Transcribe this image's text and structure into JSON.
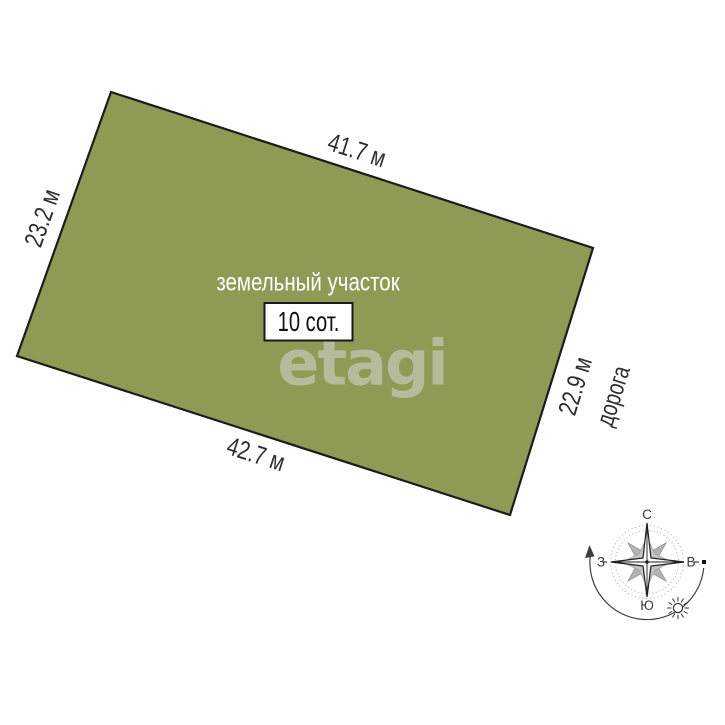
{
  "plot": {
    "label": "земельный участок",
    "area": "10 сот.",
    "fill_color": "#8e9b55",
    "border_color": "#1c1c1c",
    "dimensions": {
      "top": "41.7 м",
      "left": "23.2 м",
      "right": "22.9 м",
      "bottom": "42.7 м"
    }
  },
  "road_label": "дорога",
  "watermark": "etagi",
  "compass": {
    "north": "С",
    "south": "Ю",
    "west": "З",
    "east": "В"
  }
}
